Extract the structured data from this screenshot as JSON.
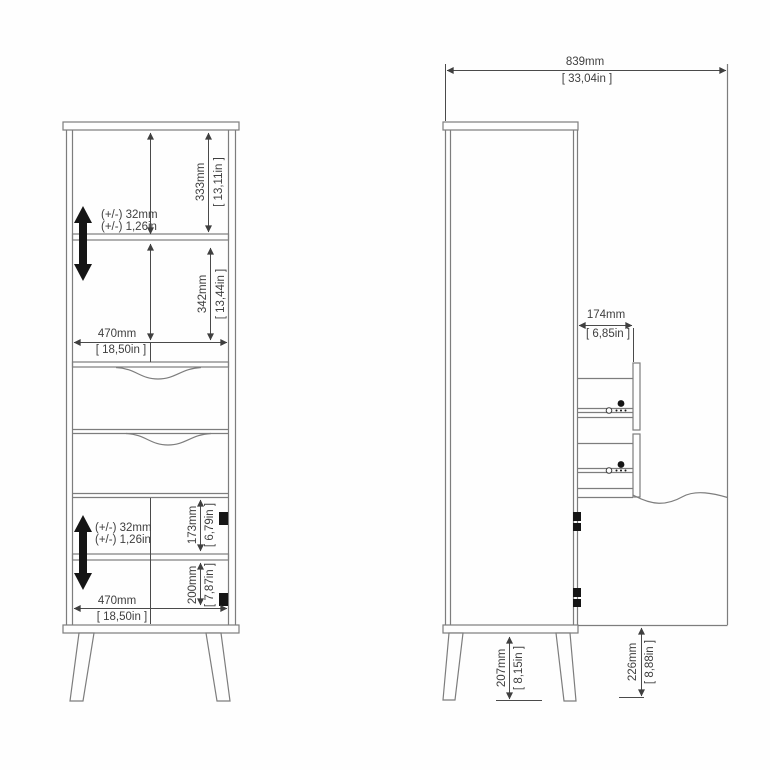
{
  "front_view": {
    "upper_compartment_height": {
      "mm": "333mm",
      "in": "[ 13,11in ]"
    },
    "middle_compartment_height": {
      "mm": "342mm",
      "in": "[ 13,44in ]"
    },
    "inner_width_top": {
      "mm": "470mm",
      "in": "[ 18,50in ]"
    },
    "shelf_adjustment_upper": {
      "mm": "(+/-) 32mm",
      "in": "(+/-) 1,26in"
    },
    "shelf_adjustment_lower": {
      "mm": "(+/-) 32mm",
      "in": "(+/-) 1,26in"
    },
    "lower_compartment_upper_height": {
      "mm": "173mm",
      "in": "[ 6,79in ]"
    },
    "lower_compartment_lower_height": {
      "mm": "200mm",
      "in": "[ 7,87in ]"
    },
    "inner_width_bottom": {
      "mm": "470mm",
      "in": "[ 18,50in ]"
    }
  },
  "side_view": {
    "total_depth_door_open": {
      "mm": "839mm",
      "in": "[ 33,04in ]"
    },
    "drawer_extension": {
      "mm": "174mm",
      "in": "[ 6,85in ]"
    },
    "leg_height": {
      "mm": "207mm",
      "in": "[ 8,15in ]"
    },
    "door_floor_clearance": {
      "mm": "226mm",
      "in": "[ 8,88in ]"
    }
  }
}
